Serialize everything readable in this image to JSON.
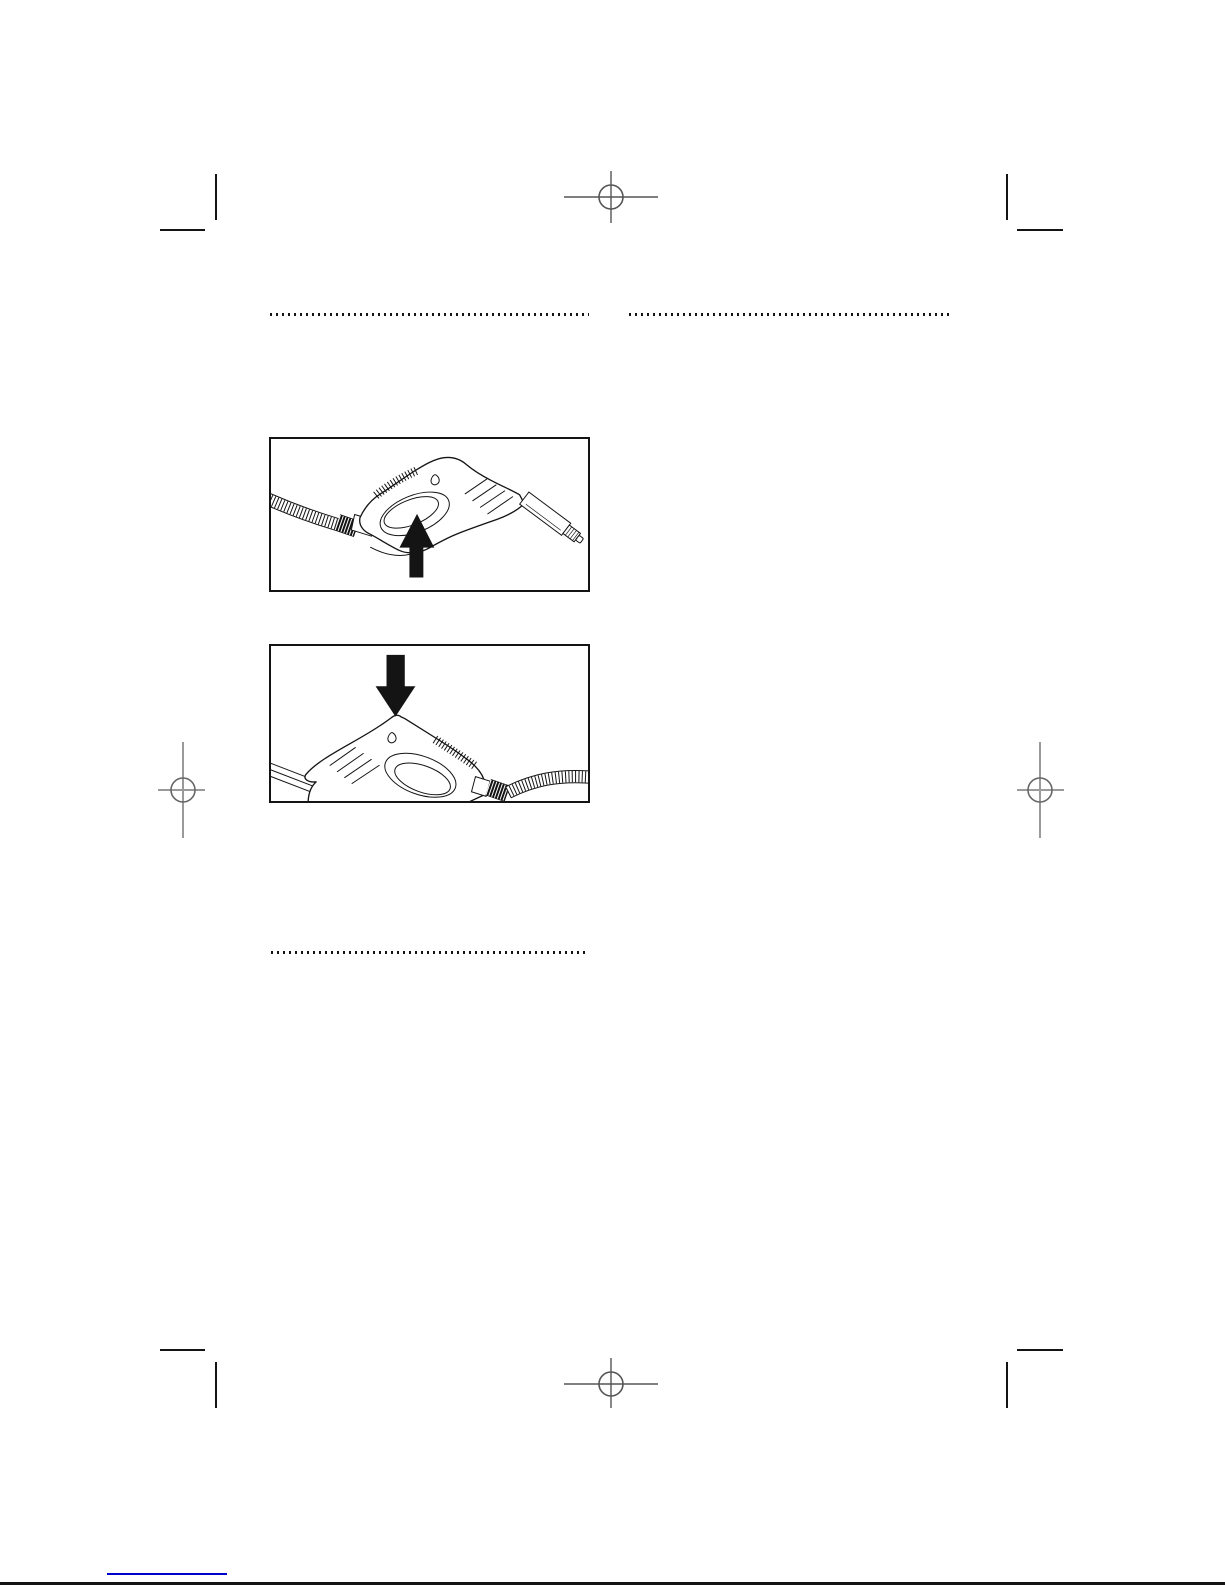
{
  "page": {
    "kind": "printed manual page scan (no visible text, illustrations only)",
    "colors": {
      "paper": "#ffffff",
      "ink": "#141414",
      "mark": "#555555",
      "mark_light": "#9a9a9a",
      "link": "#0000cc"
    }
  },
  "separators": {
    "top_left": {
      "id": "dotted-rule-top-left"
    },
    "top_right": {
      "id": "dotted-rule-top-right"
    },
    "lower_left": {
      "id": "dotted-rule-lower-left"
    }
  },
  "figures": [
    {
      "id": "figure-1",
      "description": "Line drawing of a spray-gun handle, hose entering from the left, nozzle pointing down-right; a solid black arrow points up at the trigger",
      "arrow_direction": "up"
    },
    {
      "id": "figure-2",
      "description": "Line drawing of the same spray-gun handle mirrored, lance at lower left, hose exiting right; a solid black arrow points down at the button on top of the gun",
      "arrow_direction": "down"
    }
  ],
  "printer_marks": {
    "registration_targets": [
      "top-center",
      "middle-left",
      "middle-right",
      "bottom-center"
    ],
    "corner_crop_marks": [
      "top-left",
      "top-right",
      "bottom-left",
      "bottom-right"
    ]
  },
  "footer": {
    "link_underline": {
      "note": "blue underline of a hyperlink at bottom-left"
    }
  }
}
